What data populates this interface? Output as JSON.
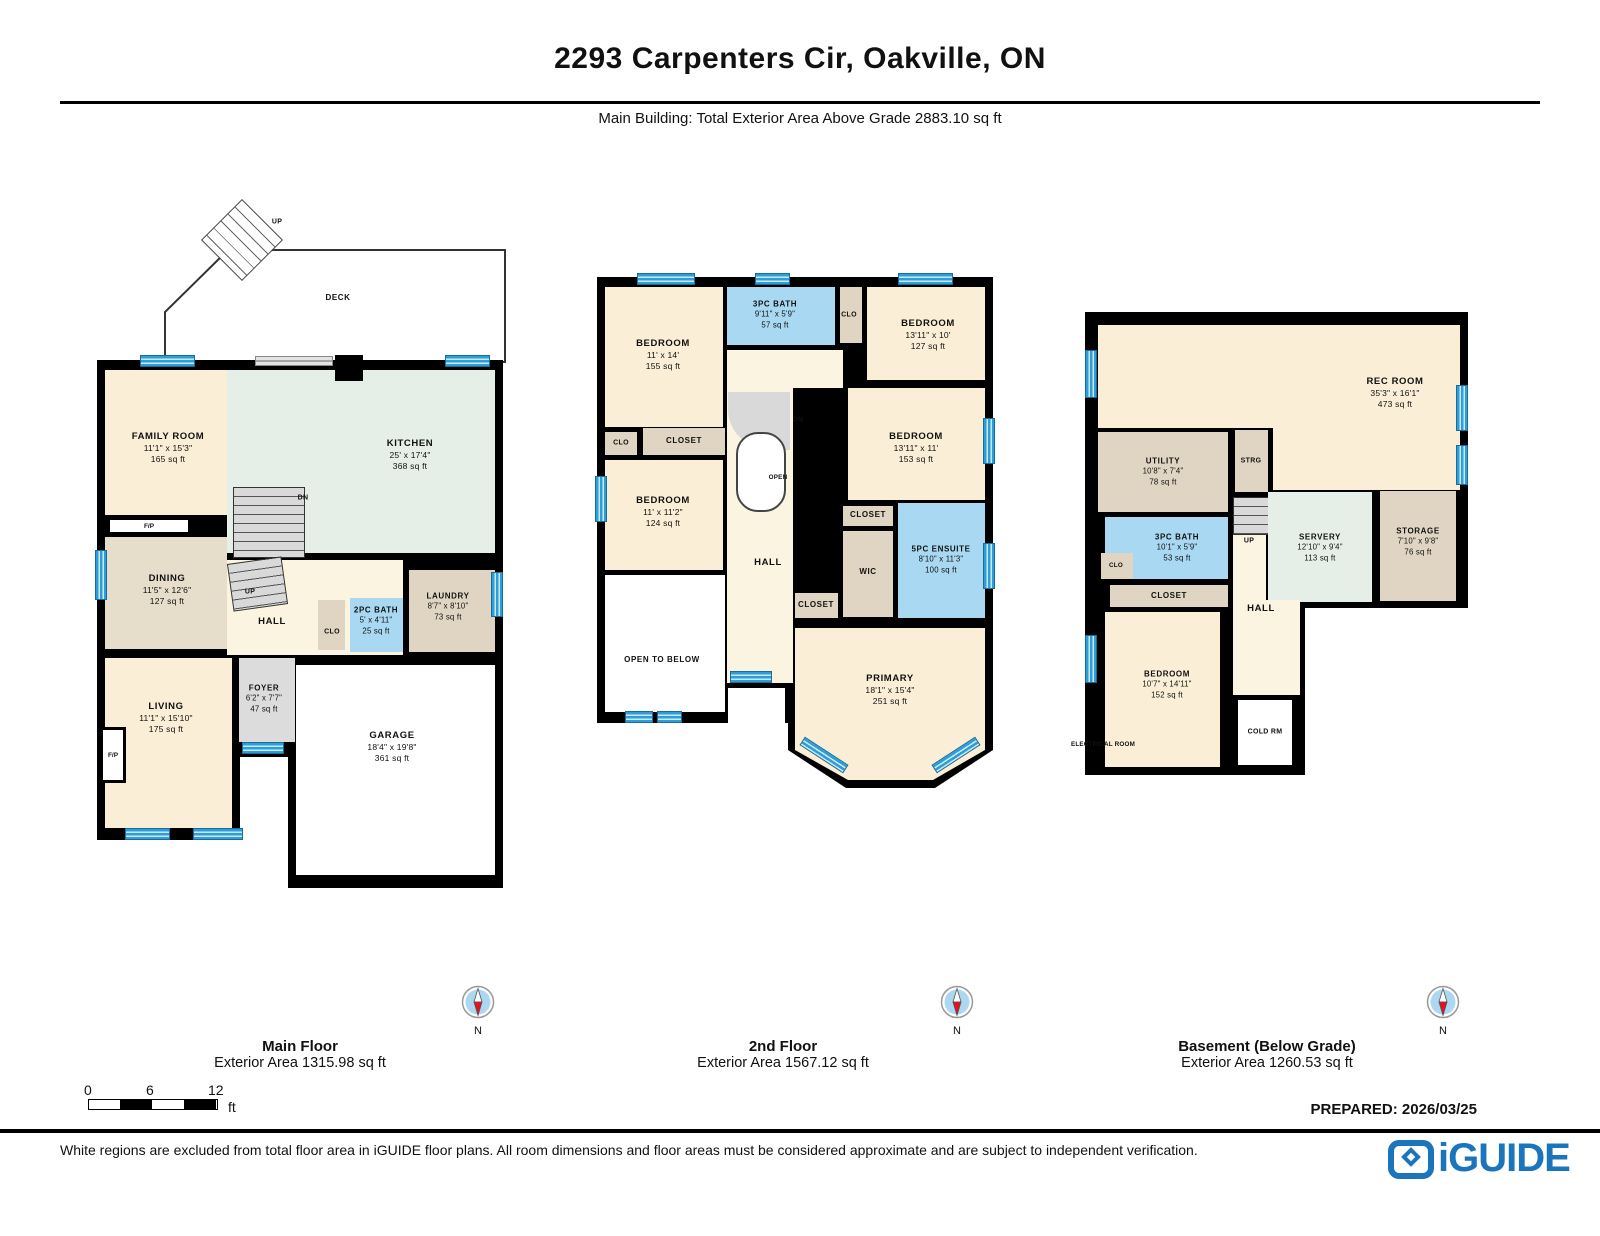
{
  "header": {
    "title": "2293 Carpenters Cir, Oakville, ON",
    "subtitle": "Main Building: Total Exterior Area Above Grade 2883.10 sq ft"
  },
  "floors": [
    {
      "name": "Main Floor",
      "area_label": "Exterior Area 1315.98 sq ft",
      "rooms": [
        {
          "name": "FAMILY ROOM",
          "dims": "11'1\" x 15'3\"",
          "area": "165 sq ft"
        },
        {
          "name": "KITCHEN",
          "dims": "25' x 17'4\"",
          "area": "368 sq ft"
        },
        {
          "name": "DINING",
          "dims": "11'5\" x 12'6\"",
          "area": "127 sq ft"
        },
        {
          "name": "LIVING",
          "dims": "11'1\" x 15'10\"",
          "area": "175 sq ft"
        },
        {
          "name": "FOYER",
          "dims": "6'2\" x 7'7\"",
          "area": "47 sq ft"
        },
        {
          "name": "GARAGE",
          "dims": "18'4\" x 19'8\"",
          "area": "361 sq ft"
        },
        {
          "name": "LAUNDRY",
          "dims": "8'7\" x 8'10\"",
          "area": "73 sq ft"
        },
        {
          "name": "2PC BATH",
          "dims": "5' x 4'11\"",
          "area": "25 sq ft"
        },
        {
          "name": "HALL"
        },
        {
          "name": "CLO"
        },
        {
          "name": "DECK"
        },
        {
          "name": "F/P"
        },
        {
          "name": "F/P"
        },
        {
          "name": "UP"
        },
        {
          "name": "DN"
        },
        {
          "name": "UP"
        }
      ]
    },
    {
      "name": "2nd Floor",
      "area_label": "Exterior Area 1567.12 sq ft",
      "rooms": [
        {
          "name": "BEDROOM",
          "dims": "11' x 14'",
          "area": "155 sq ft"
        },
        {
          "name": "3PC BATH",
          "dims": "9'11\" x 5'9\"",
          "area": "57 sq ft"
        },
        {
          "name": "CLO"
        },
        {
          "name": "BEDROOM",
          "dims": "13'11\" x 10'",
          "area": "127 sq ft"
        },
        {
          "name": "BEDROOM",
          "dims": "13'11\" x 11'",
          "area": "153 sq ft"
        },
        {
          "name": "CLO"
        },
        {
          "name": "CLOSET"
        },
        {
          "name": "BEDROOM",
          "dims": "11' x 11'2\"",
          "area": "124 sq ft"
        },
        {
          "name": "OPEN TO BELOW"
        },
        {
          "name": "HALL"
        },
        {
          "name": "CLOSET"
        },
        {
          "name": "WIC"
        },
        {
          "name": "CLOSET"
        },
        {
          "name": "5PC ENSUITE",
          "dims": "8'10\" x 11'3\"",
          "area": "100 sq ft"
        },
        {
          "name": "PRIMARY",
          "dims": "18'1\" x 15'4\"",
          "area": "251 sq ft"
        },
        {
          "name": "DN"
        },
        {
          "name": "OPEN"
        }
      ]
    },
    {
      "name": "Basement (Below Grade)",
      "area_label": "Exterior Area 1260.53 sq ft",
      "rooms": [
        {
          "name": "REC ROOM",
          "dims": "35'3\" x 16'1\"",
          "area": "473 sq ft"
        },
        {
          "name": "UTILITY",
          "dims": "10'8\" x 7'4\"",
          "area": "78 sq ft"
        },
        {
          "name": "STRG"
        },
        {
          "name": "3PC BATH",
          "dims": "10'1\" x 5'9\"",
          "area": "53 sq ft"
        },
        {
          "name": "CLO"
        },
        {
          "name": "CLOSET"
        },
        {
          "name": "SERVERY",
          "dims": "12'10\" x 9'4\"",
          "area": "113 sq ft"
        },
        {
          "name": "STORAGE",
          "dims": "7'10\" x 9'8\"",
          "area": "76 sq ft"
        },
        {
          "name": "HALL"
        },
        {
          "name": "BEDROOM",
          "dims": "10'7\" x 14'11\"",
          "area": "152 sq ft"
        },
        {
          "name": "COLD RM"
        },
        {
          "name": "ELECTRICAL ROOM"
        },
        {
          "name": "UP"
        }
      ]
    }
  ],
  "compass": {
    "label": "N"
  },
  "scale": {
    "ticks": [
      "0",
      "6",
      "12"
    ],
    "unit": "ft"
  },
  "prepared": "PREPARED: 2026/03/25",
  "footer": {
    "disclaimer": "White regions are excluded from total floor area in iGUIDE floor plans. All room dimensions and floor areas must be considered approximate and are subject to independent verification.",
    "logo_text": "iGUIDE"
  },
  "colors": {
    "room_cream": "#FAEFD6",
    "hall_cream": "#FBF4E1",
    "kitchen_green": "#E5EFE7",
    "closet_tan": "#E0D5C2",
    "dining_tan": "#E7DDCB",
    "bath_blue": "#A9D8F2",
    "stair_gray": "#D9D9D9",
    "window_blue": "#45B1E8",
    "wall_black": "#000000",
    "logo_blue": "#1B75BC",
    "compass_red": "#E8101B"
  }
}
